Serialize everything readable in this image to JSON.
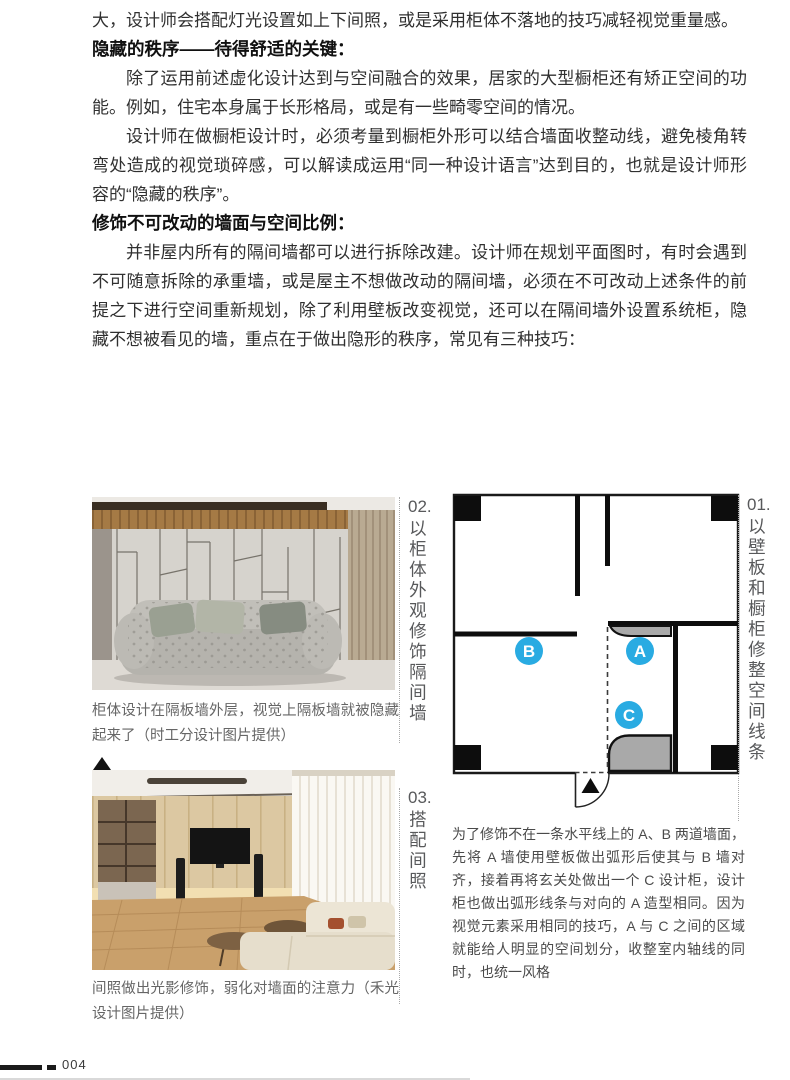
{
  "page": {
    "number": "004"
  },
  "article": {
    "intro_line": "大，设计师会搭配灯光设置如上下间照，或是采用柜体不落地的技巧减轻视觉重量感。",
    "sections": [
      {
        "heading": "隐藏的秩序——待得舒适的关键：",
        "paragraphs": [
          "除了运用前述虚化设计达到与空间融合的效果，居家的大型橱柜还有矫正空间的功能。例如，住宅本身属于长形格局，或是有一些畸零空间的情况。",
          "设计师在做橱柜设计时，必须考量到橱柜外形可以结合墙面收整动线，避免棱角转弯处造成的视觉琐碎感，可以解读成运用“同一种设计语言”达到目的，也就是设计师形容的“隐藏的秩序”。"
        ]
      },
      {
        "heading": "修饰不可改动的墙面与空间比例：",
        "paragraphs": [
          "并非屋内所有的隔间墙都可以进行拆除改建。设计师在规划平面图时，有时会遇到不可随意拆除的承重墙，或是屋主不想做改动的隔间墙，必须在不可改动上述条件的前提之下进行空间重新规划，除了利用壁板改变视觉，还可以在隔间墙外设置系统柜，隐藏不想被看见的墙，重点在于做出隐形的秩序，常见有三种技巧："
        ]
      }
    ]
  },
  "figures": {
    "tip01": {
      "number": "01.",
      "label": "以壁板和橱柜修整空间线条",
      "caption": "为了修饰不在一条水平线上的 A、B 两道墙面，先将 A 墙使用壁板做出弧形后使其与 B 墙对齐，接着再将玄关处做出一个 C 设计柜，设计柜也做出弧形线条与对向的 A 造型相同。因为视觉元素采用相同的技巧，A 与 C 之间的区域就能给人明显的空间划分，收整室内轴线的同时，也统一风格"
    },
    "tip02": {
      "number": "02.",
      "label": "以柜体外观修饰隔间墙",
      "caption": "柜体设计在隔板墙外层，视觉上隔板墙就被隐藏起来了（时工分设计图片提供）"
    },
    "tip03": {
      "number": "03.",
      "label": "搭配间照",
      "caption": "间照做出光影修饰，弱化对墙面的注意力（禾光设计图片提供）"
    },
    "floorplan": {
      "labels": {
        "a": "A",
        "b": "B",
        "c": "C"
      }
    }
  },
  "colors": {
    "accent_blue": "#29abe2",
    "cabinet_gray": "#a9a9a9",
    "wall_black": "#0d0d0d"
  }
}
